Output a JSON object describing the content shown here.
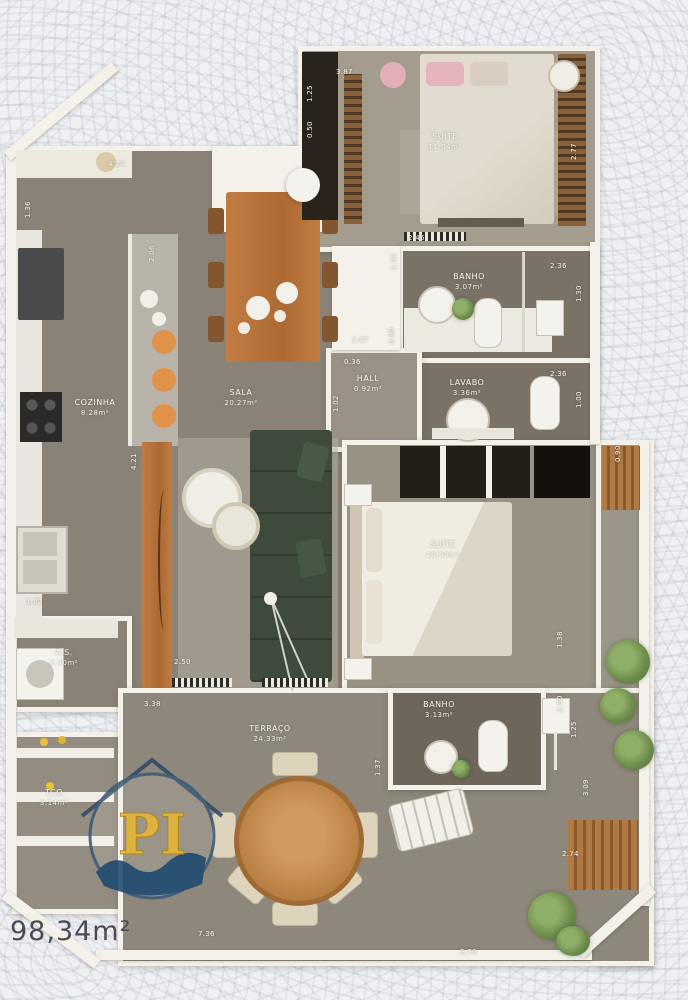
{
  "plan": {
    "total_area": "98,34m²",
    "rooms": {
      "suite1": {
        "name": "SUÍTE",
        "area": "11.04m²"
      },
      "banho1": {
        "name": "BANHO",
        "area": "3.07m²"
      },
      "lavabo": {
        "name": "LAVABO",
        "area": "3.36m²"
      },
      "hall": {
        "name": "HALL",
        "area": "0.92m²"
      },
      "cozinha": {
        "name": "COZINHA",
        "area": "8.28m²"
      },
      "sala": {
        "name": "SALA",
        "area": "20.27m²"
      },
      "suite2": {
        "name": "SUÍTE",
        "area": "10.90m²"
      },
      "area_servico": {
        "name": "A.S.",
        "area": "2.40m²"
      },
      "tco": {
        "name": "TCO",
        "area": "3.14m²"
      },
      "terraco": {
        "name": "TERRAÇO",
        "area": "24.33m²"
      },
      "banho2": {
        "name": "BANHO",
        "area": "3.13m²"
      }
    },
    "dimensions": [
      {
        "t": "3.87",
        "x": 336,
        "y": 68,
        "v": false
      },
      {
        "t": "1.25",
        "x": 306,
        "y": 102,
        "v": true
      },
      {
        "t": "0.50",
        "x": 306,
        "y": 138,
        "v": true
      },
      {
        "t": "2.77",
        "x": 570,
        "y": 160,
        "v": true
      },
      {
        "t": "2.46",
        "x": 408,
        "y": 234,
        "v": false
      },
      {
        "t": "4.24",
        "x": 108,
        "y": 160,
        "v": false
      },
      {
        "t": "1.36",
        "x": 24,
        "y": 218,
        "v": true
      },
      {
        "t": "2.06",
        "x": 148,
        "y": 262,
        "v": true
      },
      {
        "t": "1.42",
        "x": 390,
        "y": 270,
        "v": true
      },
      {
        "t": "0.90",
        "x": 388,
        "y": 344,
        "v": true
      },
      {
        "t": "1.87",
        "x": 352,
        "y": 336,
        "v": false
      },
      {
        "t": "2.36",
        "x": 550,
        "y": 262,
        "v": false
      },
      {
        "t": "1.30",
        "x": 575,
        "y": 302,
        "v": true
      },
      {
        "t": "2.36",
        "x": 550,
        "y": 370,
        "v": false
      },
      {
        "t": "1.00",
        "x": 575,
        "y": 408,
        "v": true
      },
      {
        "t": "0.36",
        "x": 344,
        "y": 358,
        "v": false
      },
      {
        "t": "1.02",
        "x": 332,
        "y": 412,
        "v": true
      },
      {
        "t": "4.21",
        "x": 130,
        "y": 470,
        "v": true
      },
      {
        "t": "1.82",
        "x": 26,
        "y": 598,
        "v": false
      },
      {
        "t": "2.50",
        "x": 174,
        "y": 658,
        "v": false
      },
      {
        "t": "3.38",
        "x": 144,
        "y": 700,
        "v": false
      },
      {
        "t": "0.90",
        "x": 614,
        "y": 462,
        "v": true
      },
      {
        "t": "1.38",
        "x": 556,
        "y": 648,
        "v": true
      },
      {
        "t": "2.50",
        "x": 556,
        "y": 712,
        "v": true
      },
      {
        "t": "1.25",
        "x": 570,
        "y": 738,
        "v": true
      },
      {
        "t": "3.09",
        "x": 582,
        "y": 796,
        "v": true
      },
      {
        "t": "2.74",
        "x": 562,
        "y": 850,
        "v": false
      },
      {
        "t": "1.37",
        "x": 374,
        "y": 776,
        "v": true
      },
      {
        "t": "7.36",
        "x": 198,
        "y": 930,
        "v": false
      },
      {
        "t": "2.70",
        "x": 460,
        "y": 948,
        "v": false
      }
    ],
    "watermark": {
      "text": "PI"
    },
    "colors": {
      "floor": "#8a8276",
      "floor_dark": "#6f675c",
      "wall": "#f3f1ea",
      "wood": "#b5713a",
      "sofa_green": "#3d4a3c",
      "stool_orange": "#e0914a",
      "logo_yellow": "#e8b93a",
      "logo_blue": "#1d4a70"
    }
  }
}
